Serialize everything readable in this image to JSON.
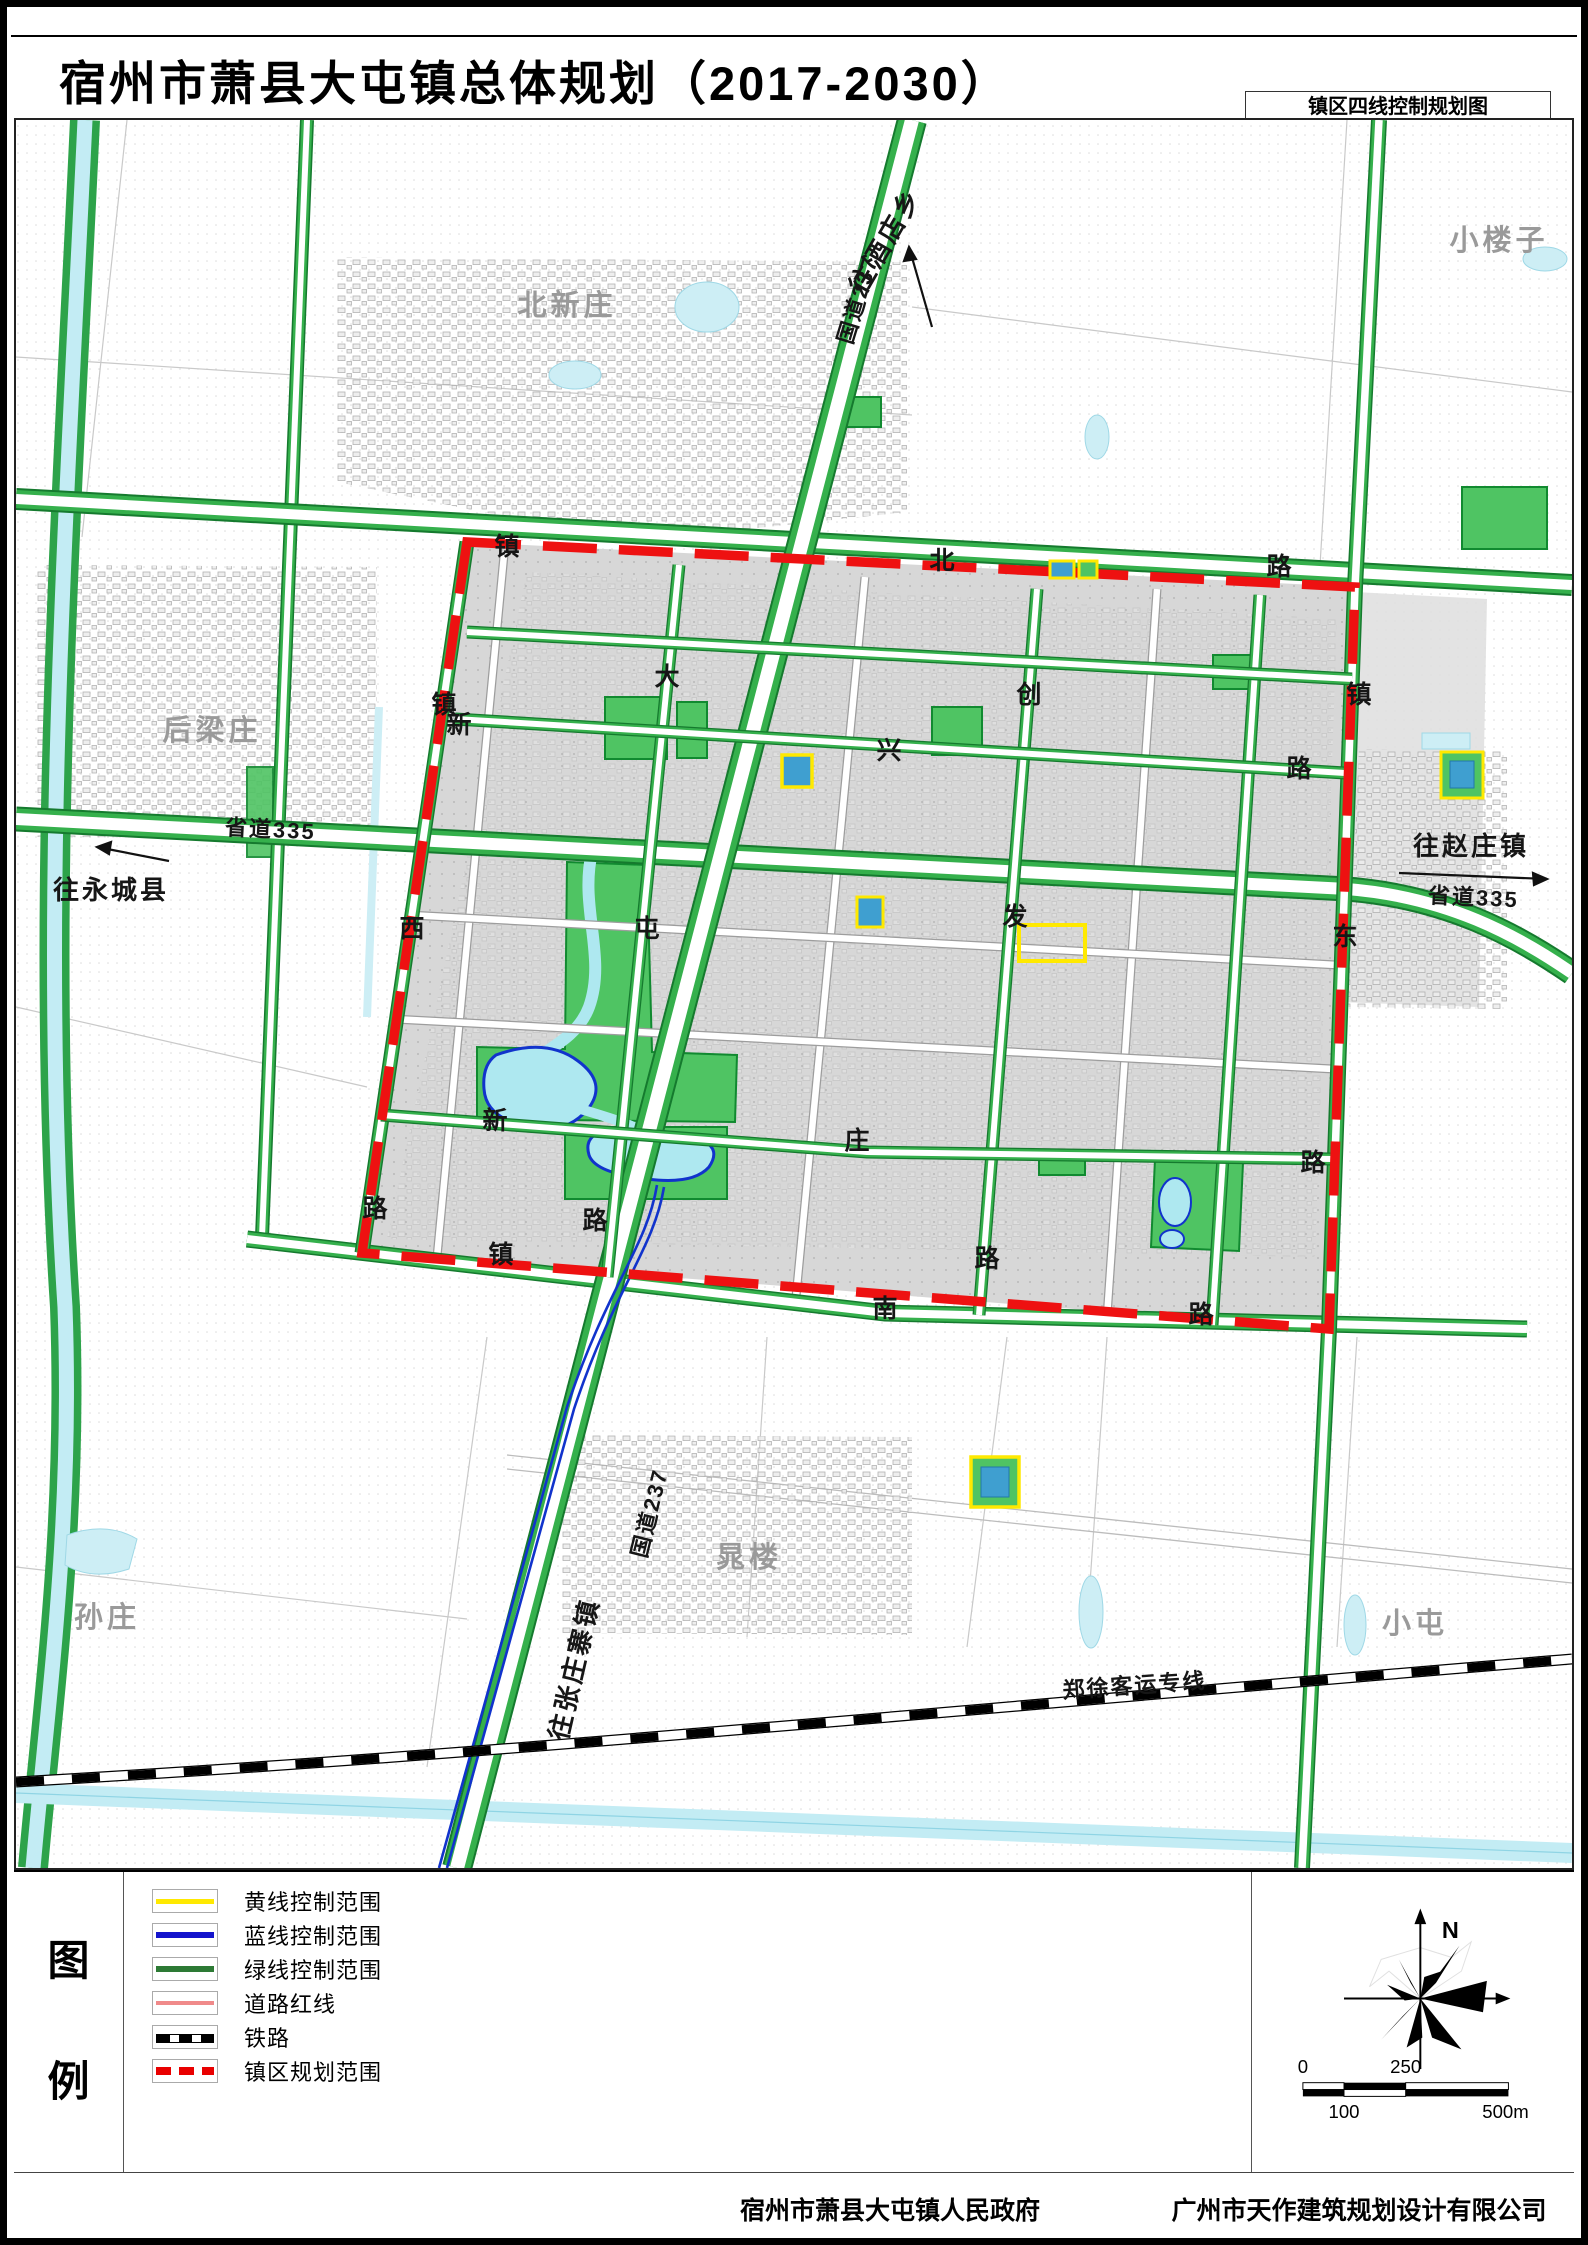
{
  "header": {
    "title": "宿州市萧县大屯镇总体规划（2017-2030）",
    "subtitle": "镇区四线控制规划图"
  },
  "legend": {
    "label_char_1": "图",
    "label_char_2": "例",
    "items": [
      {
        "label": "黄线控制范围",
        "type": "yellow"
      },
      {
        "label": "蓝线控制范围",
        "type": "blue"
      },
      {
        "label": "绿线控制范围",
        "type": "green"
      },
      {
        "label": "道路红线",
        "type": "redline"
      },
      {
        "label": "铁路",
        "type": "rail"
      },
      {
        "label": "镇区规划范围",
        "type": "reddash"
      }
    ]
  },
  "compass": {
    "north_label": "N"
  },
  "scalebar": {
    "t0": "0",
    "t100": "100",
    "t250": "250",
    "t500": "500m"
  },
  "footer": {
    "left_org": "宿州市萧县大屯镇人民政府",
    "right_org": "广州市天作建筑规划设计有限公司"
  },
  "colors": {
    "boundary_red": "#ee1111",
    "road_green": "#35b04c",
    "park_green": "#4fc463",
    "water_fill": "#aee8f0",
    "water_line": "#1133cc",
    "yellow_line": "#ffe900",
    "blue_area": "#3f9fd0",
    "urban_gray": "#d7d7d7"
  },
  "map": {
    "labels": [
      {
        "t": "北新庄",
        "x": 560,
        "y": 308,
        "r": 0,
        "c": "lbl-v"
      },
      {
        "t": "小楼子",
        "x": 1492,
        "y": 243,
        "r": 0,
        "c": "lbl-v"
      },
      {
        "t": "后梁庄",
        "x": 205,
        "y": 733,
        "r": 0,
        "c": "lbl-v"
      },
      {
        "t": "孙庄",
        "x": 100,
        "y": 1620,
        "r": 0,
        "c": "lbl-v"
      },
      {
        "t": "晁楼",
        "x": 742,
        "y": 1560,
        "r": 0,
        "c": "lbl-v"
      },
      {
        "t": "小屯",
        "x": 1408,
        "y": 1626,
        "r": 0,
        "c": "lbl-v"
      },
      {
        "t": "国道237",
        "x": 858,
        "y": 295,
        "r": -73,
        "c": "lbl-r"
      },
      {
        "t": "国道237",
        "x": 650,
        "y": 1508,
        "r": -76,
        "c": "lbl-r"
      },
      {
        "t": "省道335",
        "x": 263,
        "y": 830,
        "r": 3,
        "c": "lbl-r"
      },
      {
        "t": "省道335",
        "x": 1466,
        "y": 898,
        "r": 3,
        "c": "lbl-r"
      },
      {
        "t": "郑徐客运专线",
        "x": 1128,
        "y": 1686,
        "r": -4,
        "c": "lbl-r"
      },
      {
        "t": "往酒店乡",
        "x": 886,
        "y": 238,
        "r": -60,
        "c": "lbl-dest"
      },
      {
        "t": "往永城县",
        "x": 104,
        "y": 892,
        "r": 0,
        "c": "lbl-dest"
      },
      {
        "t": "往赵庄镇",
        "x": 1464,
        "y": 848,
        "r": 0,
        "c": "lbl-dest"
      },
      {
        "t": "往张庄寨镇",
        "x": 576,
        "y": 1664,
        "r": -77,
        "c": "lbl-dest"
      },
      {
        "t": "镇",
        "x": 500,
        "y": 548,
        "r": 0,
        "c": "lbl-c"
      },
      {
        "t": "北",
        "x": 935,
        "y": 562,
        "r": 0,
        "c": "lbl-c"
      },
      {
        "t": "路",
        "x": 1272,
        "y": 568,
        "r": 0,
        "c": "lbl-c"
      },
      {
        "t": "镇",
        "x": 437,
        "y": 706,
        "r": 0,
        "c": "lbl-c"
      },
      {
        "t": "西",
        "x": 405,
        "y": 930,
        "r": 0,
        "c": "lbl-c"
      },
      {
        "t": "路",
        "x": 368,
        "y": 1210,
        "r": 0,
        "c": "lbl-c"
      },
      {
        "t": "镇",
        "x": 1352,
        "y": 696,
        "r": 0,
        "c": "lbl-c"
      },
      {
        "t": "东",
        "x": 1338,
        "y": 938,
        "r": 0,
        "c": "lbl-c"
      },
      {
        "t": "镇",
        "x": 494,
        "y": 1256,
        "r": 0,
        "c": "lbl-c"
      },
      {
        "t": "南",
        "x": 878,
        "y": 1310,
        "r": 0,
        "c": "lbl-c"
      },
      {
        "t": "路",
        "x": 1194,
        "y": 1316,
        "r": 0,
        "c": "lbl-c"
      },
      {
        "t": "大",
        "x": 660,
        "y": 678,
        "r": 0,
        "c": "lbl-c"
      },
      {
        "t": "屯",
        "x": 640,
        "y": 930,
        "r": 0,
        "c": "lbl-c"
      },
      {
        "t": "路",
        "x": 588,
        "y": 1222,
        "r": 0,
        "c": "lbl-c"
      },
      {
        "t": "新",
        "x": 452,
        "y": 726,
        "r": 0,
        "c": "lbl-c"
      },
      {
        "t": "兴",
        "x": 882,
        "y": 752,
        "r": 0,
        "c": "lbl-c"
      },
      {
        "t": "路",
        "x": 1292,
        "y": 770,
        "r": 0,
        "c": "lbl-c"
      },
      {
        "t": "创",
        "x": 1022,
        "y": 696,
        "r": 0,
        "c": "lbl-c"
      },
      {
        "t": "发",
        "x": 1008,
        "y": 918,
        "r": 0,
        "c": "lbl-c"
      },
      {
        "t": "路",
        "x": 980,
        "y": 1260,
        "r": 0,
        "c": "lbl-c"
      },
      {
        "t": "新",
        "x": 488,
        "y": 1122,
        "r": 0,
        "c": "lbl-c"
      },
      {
        "t": "庄",
        "x": 850,
        "y": 1142,
        "r": 0,
        "c": "lbl-c"
      },
      {
        "t": "路",
        "x": 1306,
        "y": 1164,
        "r": 0,
        "c": "lbl-c"
      }
    ]
  }
}
